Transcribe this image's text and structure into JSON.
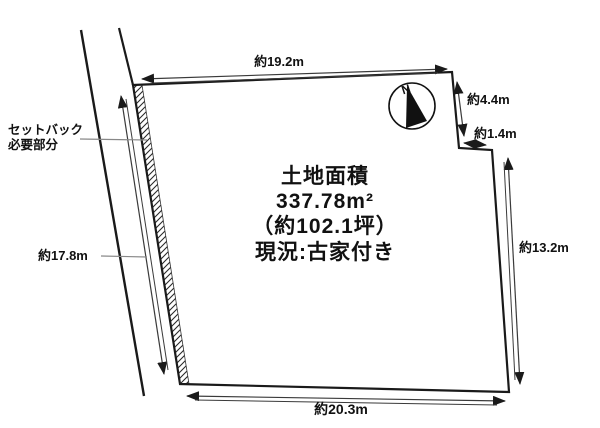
{
  "diagram": {
    "type": "land-plot-survey",
    "colors": {
      "background": "#ffffff",
      "ink": "#1a1a1a",
      "dim_line": "#3a3a3a",
      "leader": "#888888"
    },
    "area_info": {
      "title": "土地面積",
      "area_m2": "337.78m²",
      "area_tsubo": "（約102.1坪）",
      "current_status": "現況:古家付き"
    },
    "dimensions": {
      "top": "約19.2m",
      "right_upper": "約4.4m",
      "right_notch": "約1.4m",
      "right": "約13.2m",
      "bottom": "約20.3m",
      "left": "約17.8m"
    },
    "setback_label": {
      "line1": "セットバック",
      "line2": "必要部分"
    },
    "compass": {
      "north_label": "N"
    }
  }
}
